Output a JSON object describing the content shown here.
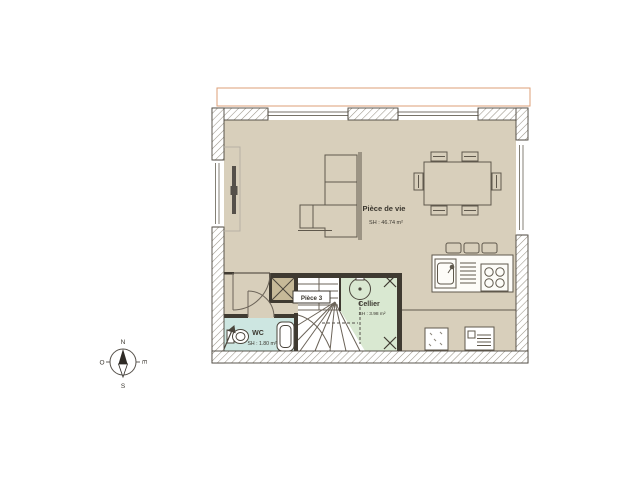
{
  "rooms": {
    "living": {
      "name": "Pièce de vie",
      "area": "SH : 46.74 m²"
    },
    "cellier": {
      "name": "Cellier",
      "area": "SH : 3.98 m²"
    },
    "wc": {
      "name": "WC",
      "area": "SH : 1.80 m²"
    },
    "piece3": {
      "name": "Pièce 3"
    }
  },
  "compass": {
    "north": "N",
    "south": "S",
    "east": "E",
    "west": "O"
  },
  "colors": {
    "floor": "#d8cfbb",
    "wc": "#cde6e1",
    "cellier": "#d9e8d1",
    "closet": "#c6b998",
    "wall": "#3f3a31",
    "line": "#5f584c",
    "hatch": "#9a9488",
    "terrace": "#dd9f77"
  }
}
